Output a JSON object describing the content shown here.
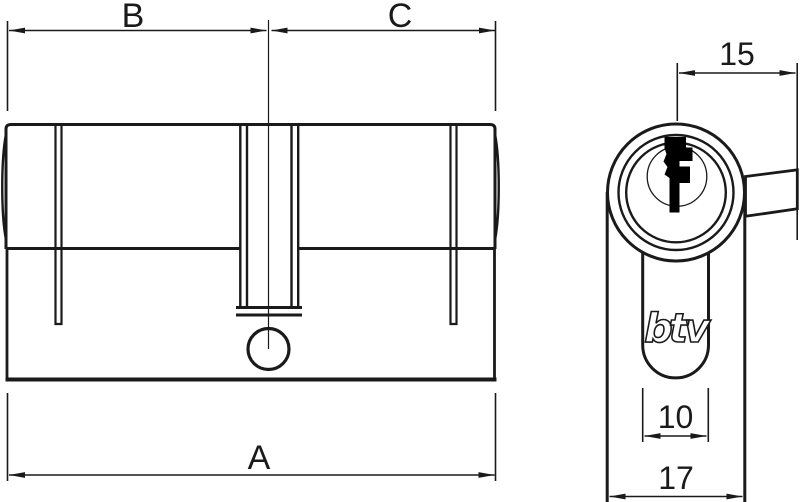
{
  "diagram": {
    "labels": {
      "dim_b": "B",
      "dim_c": "C",
      "dim_a": "A",
      "dim_cam": "15",
      "dim_keyway": "10",
      "dim_width": "17"
    },
    "logo": "btv",
    "colors": {
      "line": "#1a1a1a",
      "background": "#ffffff",
      "keyway": "#000000"
    }
  }
}
